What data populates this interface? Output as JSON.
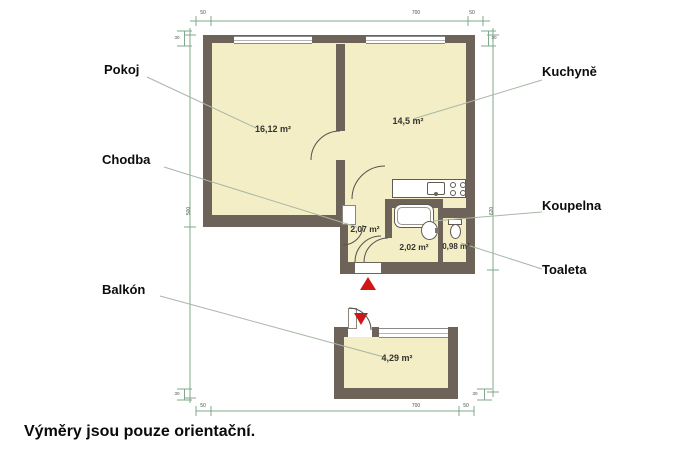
{
  "title_note": "Výměry jsou pouze orientační.",
  "rooms": {
    "pokoj": {
      "label": "Pokoj",
      "area": "16,12 m²"
    },
    "kuchyne": {
      "label": "Kuchyně",
      "area": "14,5 m²"
    },
    "chodba": {
      "label": "Chodba",
      "area": "2,07 m²"
    },
    "koupelna": {
      "label": "Koupelna",
      "area": "2,02 m²"
    },
    "toaleta": {
      "label": "Toaleta",
      "area": "0,98 m²"
    },
    "balkon": {
      "label": "Balkón",
      "area": "4,29 m²"
    }
  },
  "dimensions": {
    "top": {
      "left": "50",
      "middle": "700",
      "right": "50"
    },
    "bottom": {
      "left": "50",
      "middle": "700",
      "right": "50"
    },
    "left_side": "500",
    "right_side": "620",
    "wall_marks": {
      "top_left": "30",
      "top_right": "30",
      "bottom_left": "30",
      "bottom_right": "30"
    }
  },
  "fixtures": [
    "kitchen-counter",
    "kitchen-sink",
    "stove",
    "bathtub",
    "washbasin",
    "toilet"
  ],
  "colors": {
    "wall": "#6d6359",
    "room_fill": "#f3eec6",
    "dimension": "#7fa88a",
    "leader": "#a8b7a6",
    "arrow": "#cf1717",
    "text": "#111111"
  }
}
